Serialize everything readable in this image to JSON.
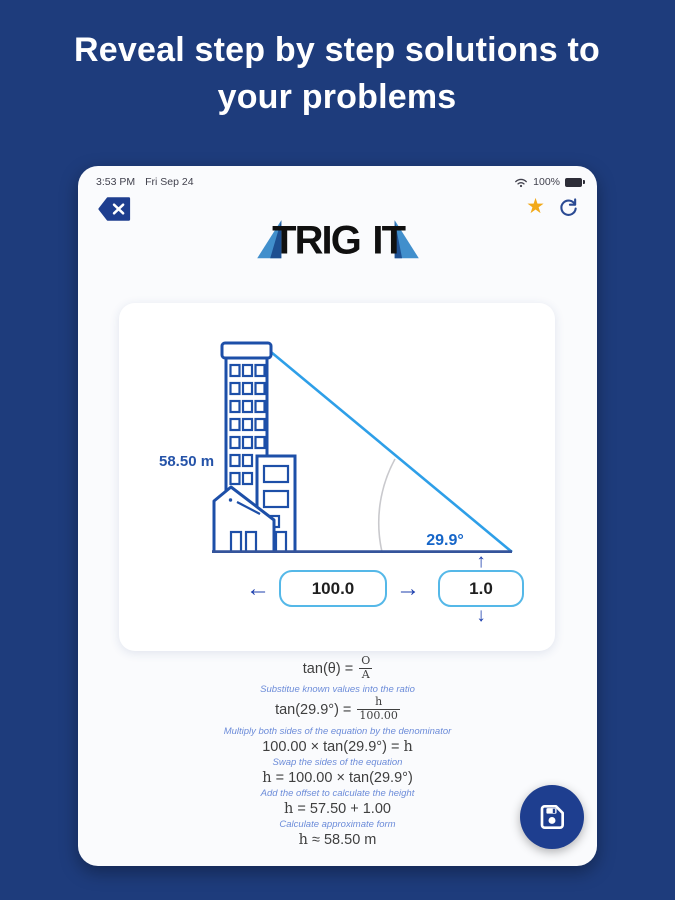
{
  "headline": "Reveal step by step solutions to your problems",
  "status_bar": {
    "time": "3:53 PM",
    "date": "Fri Sep 24",
    "battery_percent": "100%"
  },
  "logo": {
    "word1": "TRIG",
    "word2": "IT"
  },
  "diagram": {
    "height_label": "58.50 m",
    "angle_label": "29.9°"
  },
  "inputs": {
    "adjacent_value": "100.0",
    "offset_value": "1.0",
    "left_arrow": "←",
    "right_arrow": "→",
    "up_arrow": "↑",
    "down_arrow": "↓"
  },
  "steps": [
    {
      "kind": "eq",
      "parts": [
        {
          "t": "txt",
          "v": "tan(θ) = "
        },
        {
          "t": "frac",
          "num": "O",
          "den": "A"
        }
      ]
    },
    {
      "kind": "desc",
      "text": "Substitue known values into the ratio"
    },
    {
      "kind": "eq",
      "parts": [
        {
          "t": "txt",
          "v": "tan(29.9°) = "
        },
        {
          "t": "frac",
          "num": "h",
          "den": "100.00"
        }
      ]
    },
    {
      "kind": "desc",
      "text": "Multiply both sides of the equation by the denominator"
    },
    {
      "kind": "eq",
      "parts": [
        {
          "t": "txt",
          "v": "100.00 × tan(29.9°) = "
        },
        {
          "t": "var",
          "v": "h"
        }
      ]
    },
    {
      "kind": "desc",
      "text": "Swap the sides of the equation"
    },
    {
      "kind": "eq",
      "parts": [
        {
          "t": "var",
          "v": "h"
        },
        {
          "t": "txt",
          "v": " = 100.00 × tan(29.9°)"
        }
      ]
    },
    {
      "kind": "desc",
      "text": "Add the offset to calculate the height"
    },
    {
      "kind": "eq",
      "parts": [
        {
          "t": "var",
          "v": "h"
        },
        {
          "t": "txt",
          "v": " = 57.50 + 1.00"
        }
      ]
    },
    {
      "kind": "desc",
      "text": "Calculate approximate form"
    },
    {
      "kind": "eq",
      "parts": [
        {
          "t": "var",
          "v": "h"
        },
        {
          "t": "txt",
          "v": " ≈ 58.50 m"
        }
      ]
    }
  ],
  "colors": {
    "page_bg": "#1e3c7c",
    "accent_navy": "#1e3e8f",
    "building_blue": "#1d4fa8",
    "hypotenuse_blue": "#2e9fe8",
    "ground_blue": "#35549b",
    "angle_text_blue": "#1565c8",
    "star_gold": "#f2a918",
    "box_border_blue": "#55b8e8",
    "step_desc_blue": "#6c8cd9"
  }
}
